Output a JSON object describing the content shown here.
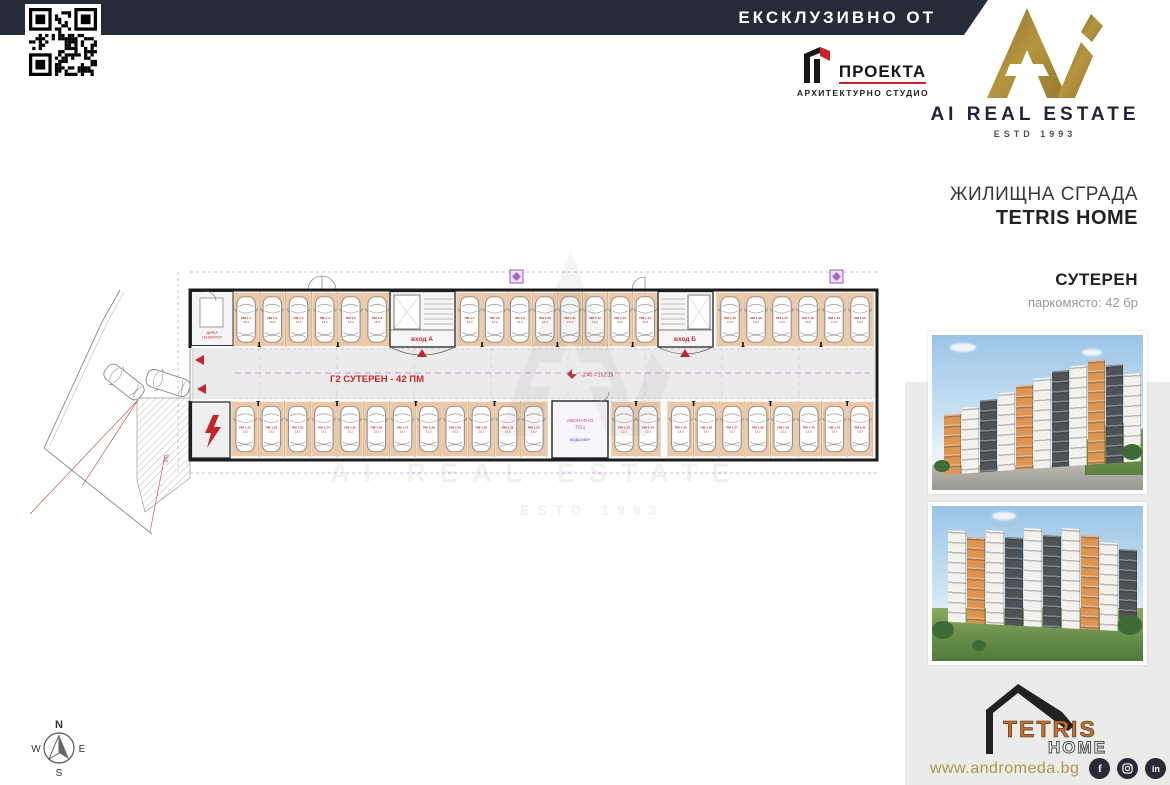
{
  "header": {
    "banner": "ЕКСКЛУЗИВНО ОТ",
    "banner_bg": "#272b38"
  },
  "proekta": {
    "name": "ПРОЕКТА",
    "subtitle": "АРХИТЕКТУРНО СТУДИО",
    "accent": "#c8232b"
  },
  "brand": {
    "name": "AI REAL ESTATE",
    "estd": "ESTD 1993",
    "gold": "#a5853c",
    "navy": "#20243a"
  },
  "project": {
    "building_type": "ЖИЛИЩНА СГРАДА",
    "name": "TETRIS HOME",
    "floor": "СУТЕРЕН",
    "subtitle": "паркомясто: 42 бр"
  },
  "plan": {
    "title": "Г2  СУТЕРЕН - 42 ПМ",
    "entrance_a": "вход А",
    "entrance_b": "вход Б",
    "elevation": "-3.40 = 152.15",
    "slope": "5%",
    "stall_prefix": "ПМ 1.",
    "stall_area": "13.2",
    "rooms": {
      "heat1": "АБОНАТНО",
      "heat2": "ТЕЦ",
      "meter": "ВОДОМЕР",
      "gen1": "ДИЗЕЛ",
      "gen2": "ГЕНЕРАТОР"
    },
    "colors": {
      "stall": "#ecc9a4",
      "stall_edge": "#c49a6c",
      "red": "#c1272d",
      "violet": "#b678d0",
      "aisle": "#ebebeb",
      "wall": "#1d1d1d"
    },
    "layout": {
      "top": {
        "y": 62,
        "h": 55,
        "segments": [
          {
            "x": 213,
            "w": 26.2,
            "count": 6
          },
          {
            "x": 437,
            "w": 25.1,
            "count": 8
          },
          {
            "x": 697,
            "w": 26.0,
            "count": 6
          }
        ]
      },
      "bottom": {
        "y": 171,
        "h": 56,
        "segments": [
          {
            "x": 212,
            "w": 26.25,
            "count": 12
          },
          {
            "x": 592,
            "w": 24.0,
            "count": 2
          },
          {
            "x": 648,
            "w": 25.6,
            "count": 8
          }
        ]
      }
    },
    "total_stalls": 42
  },
  "watermark": {
    "line1": "AI REAL ESTATE",
    "line2": "ESTD 1993"
  },
  "renders": {
    "palette": {
      "orange": "#dd9553",
      "white": "#f3f1ec",
      "dark": "#4e5358"
    }
  },
  "tetris": {
    "word": "TETRIS",
    "home": "HOME",
    "orange": "#c96f2a"
  },
  "footer": {
    "website": "www.andromeda.bg",
    "social": [
      "facebook",
      "instagram",
      "linkedin"
    ]
  },
  "compass": {
    "n": "N",
    "e": "E",
    "s": "S",
    "w": "W"
  }
}
